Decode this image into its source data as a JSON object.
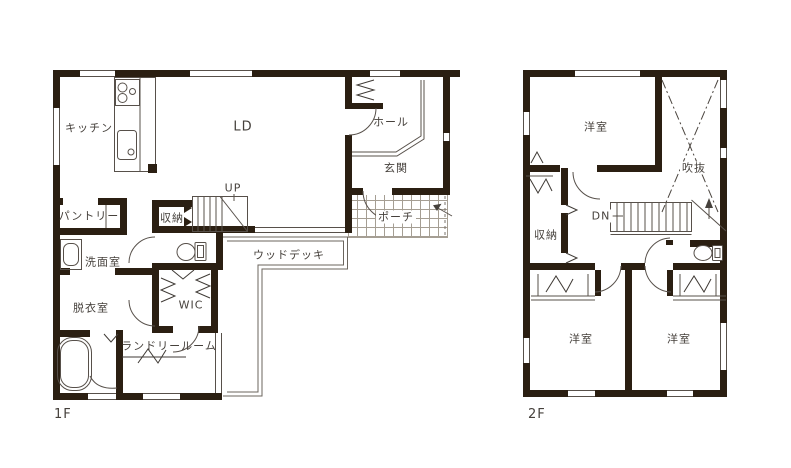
{
  "floor1": {
    "label": "1F",
    "rooms": {
      "kitchen": "キッチン",
      "ld": "LD",
      "hall": "ホール",
      "entrance": "玄関",
      "pantry": "パントリー",
      "storage": "収納",
      "stairs_up": "UP",
      "porch": "ポーチ",
      "washroom": "洗面室",
      "wood_deck": "ウッドデッキ",
      "dressing_room": "脱衣室",
      "wic": "WIC",
      "laundry_room": "ランドリールーム"
    }
  },
  "floor2": {
    "label": "2F",
    "rooms": {
      "bedroom_1": "洋室",
      "void_above": "吹抜",
      "storage": "収納",
      "stairs_down": "DN",
      "bedroom_2": "洋室",
      "bedroom_3": "洋室"
    }
  },
  "colors": {
    "wall": "#2b1f12",
    "thin_line": "#57504a",
    "text": "#46413c",
    "porch_grid": "#a59e93",
    "background": "#ffffff"
  }
}
